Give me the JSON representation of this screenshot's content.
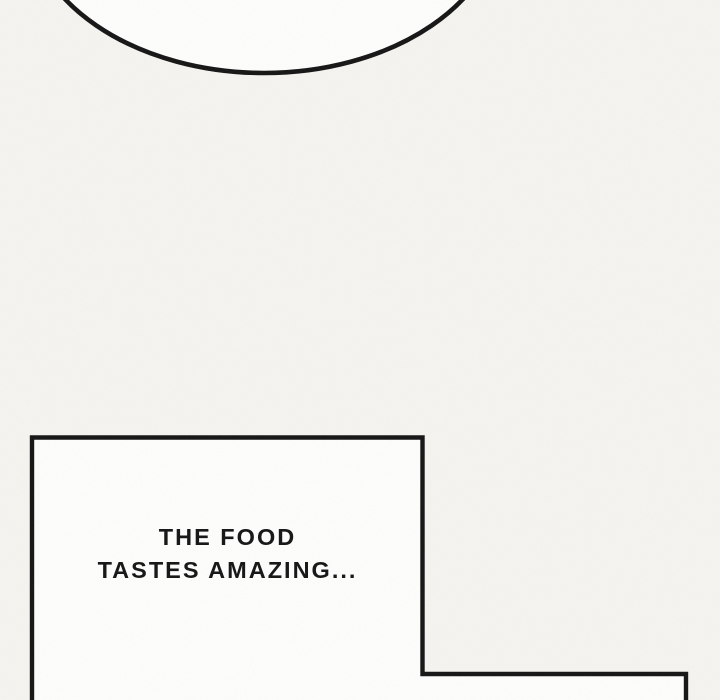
{
  "panel": {
    "dialogue": {
      "line1": "THE FOOD",
      "line2": "TASTES AMAZING..."
    }
  },
  "colors": {
    "paper": "#f5f4f0",
    "bubble-fill": "#fdfdfc",
    "ink": "#161616"
  }
}
